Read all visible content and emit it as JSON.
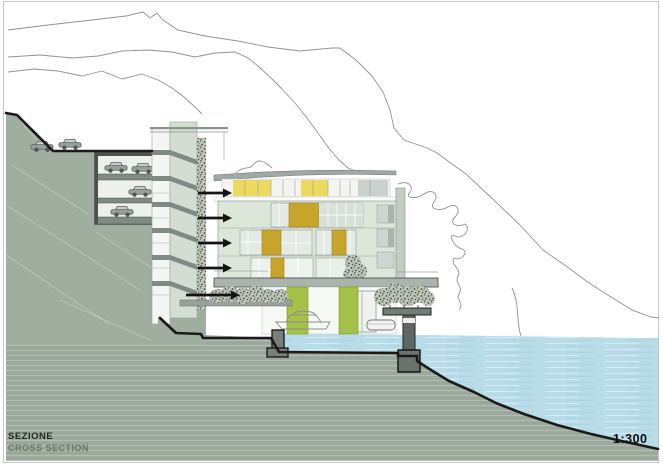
{
  "title_block": {
    "title": "SEZIONE",
    "subtitle": "CROSS SECTION"
  },
  "scale": {
    "label": "1:300"
  },
  "colors": {
    "water": "#b9dde8",
    "ground": "#9dab9e",
    "hill": "#9fae9f",
    "facade": "#dde7d9",
    "penthouse_yellow": "#ecd95d",
    "ochre_panel": "#c7a42c",
    "lime_column": "#a6c148",
    "roof_gray": "#9fa8a5",
    "slab_gray": "#7f8a84",
    "arrow": "#141414",
    "outline_black": "#1a1a1a",
    "contour_gray": "#8f9590",
    "vegetation": "#3f4a40"
  }
}
